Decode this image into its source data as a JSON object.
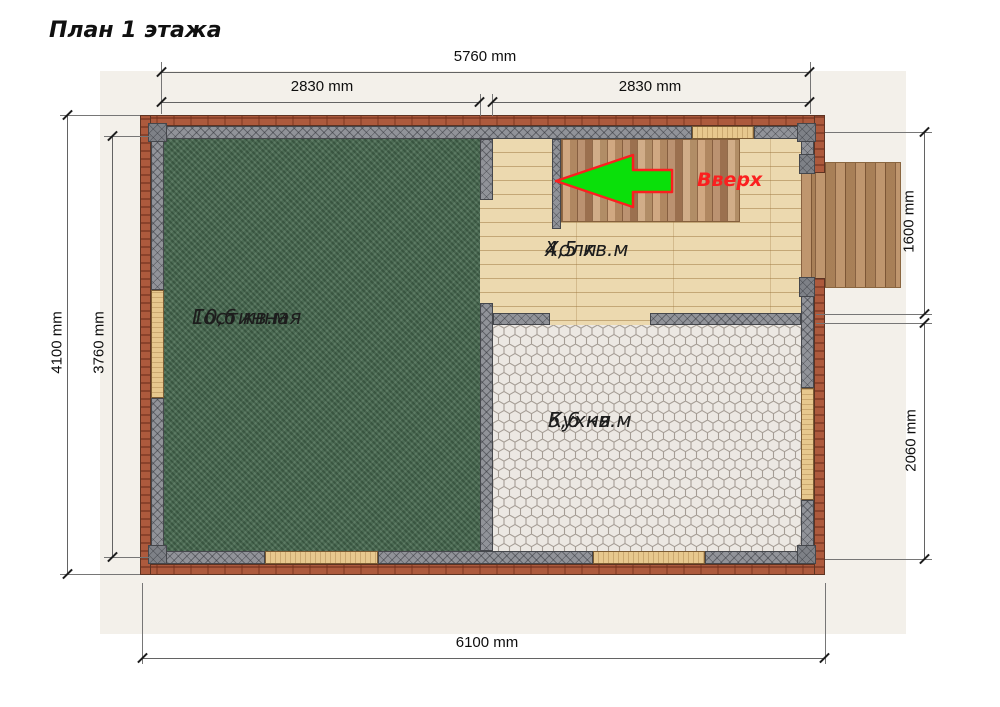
{
  "title": "План 1 этажа",
  "rooms": [
    {
      "name": "Гостинная",
      "area": "10,6 кв.м"
    },
    {
      "name": "Холл",
      "area": "4,5 кв.м"
    },
    {
      "name": "Кухня",
      "area": "5,6 кв.м"
    }
  ],
  "stairs": {
    "direction_label": "Вверх"
  },
  "dimensions": {
    "top_total": "5760 mm",
    "top_left_span": "2830 mm",
    "top_right_span": "2830 mm",
    "left_outer": "4100 mm",
    "left_inner": "3760 mm",
    "right_upper": "1600 mm",
    "right_lower": "2060 mm",
    "bottom_total": "6100 mm"
  },
  "colors": {
    "brick": "#ad5a3d",
    "wall_gray": "#919399",
    "carpet_green": "#4d6e55",
    "hall_wood": "#ecd9af",
    "stair_wood": "#c09268",
    "kitchen_tile": "#ece8e3",
    "arrow_green": "#0ae00a",
    "arrow_outline_red": "#fb1f1f",
    "background_panel": "#f3f0ea"
  }
}
